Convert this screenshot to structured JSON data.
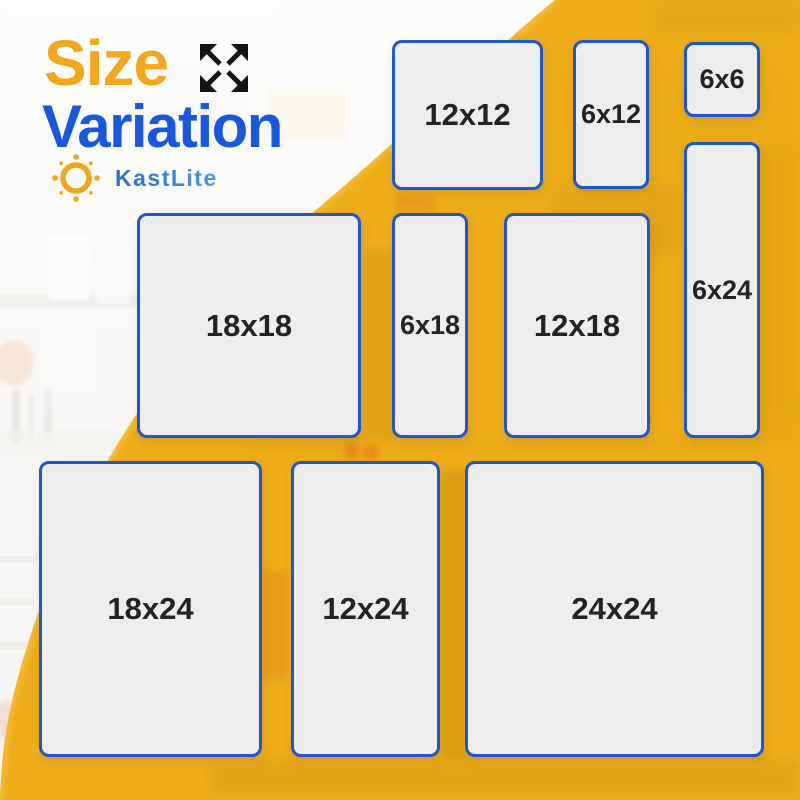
{
  "brand": {
    "name": "KastLite",
    "logo_icon": "sun-icon"
  },
  "header": {
    "title_line1": "Size",
    "title_line2": "Variation",
    "title_icon": "expand-arrows-icon"
  },
  "size_cards": [
    {
      "label": "12x12",
      "width_in": 12,
      "height_in": 12,
      "x": 392,
      "y": 40,
      "w": 151,
      "h": 150
    },
    {
      "label": "6x12",
      "width_in": 6,
      "height_in": 12,
      "x": 573,
      "y": 40,
      "w": 76,
      "h": 149
    },
    {
      "label": "6x6",
      "width_in": 6,
      "height_in": 6,
      "x": 684,
      "y": 42,
      "w": 76,
      "h": 75
    },
    {
      "label": "6x24",
      "width_in": 6,
      "height_in": 24,
      "x": 684,
      "y": 142,
      "w": 76,
      "h": 296
    },
    {
      "label": "18x18",
      "width_in": 18,
      "height_in": 18,
      "x": 137,
      "y": 213,
      "w": 224,
      "h": 225
    },
    {
      "label": "6x18",
      "width_in": 6,
      "height_in": 18,
      "x": 392,
      "y": 213,
      "w": 76,
      "h": 225
    },
    {
      "label": "12x18",
      "width_in": 12,
      "height_in": 18,
      "x": 504,
      "y": 213,
      "w": 146,
      "h": 225
    },
    {
      "label": "18x24",
      "width_in": 18,
      "height_in": 24,
      "x": 39,
      "y": 461,
      "w": 223,
      "h": 296
    },
    {
      "label": "12x24",
      "width_in": 12,
      "height_in": 24,
      "x": 291,
      "y": 461,
      "w": 149,
      "h": 296
    },
    {
      "label": "24x24",
      "width_in": 24,
      "height_in": 24,
      "x": 465,
      "y": 461,
      "w": 299,
      "h": 296
    }
  ],
  "colors": {
    "background_yellow": "#EEAE1B",
    "card_background": "#EDEDED",
    "card_border_blue": "#1E55D0",
    "card_label": "#232326",
    "title_orange": "#F4A71D",
    "title_blue": "#1A57E0",
    "brand_blue_dark": "#2B6FC8",
    "brand_blue_light": "#4C96E8",
    "arrows_black": "#151515",
    "sun_orange": "#F2A51E"
  }
}
